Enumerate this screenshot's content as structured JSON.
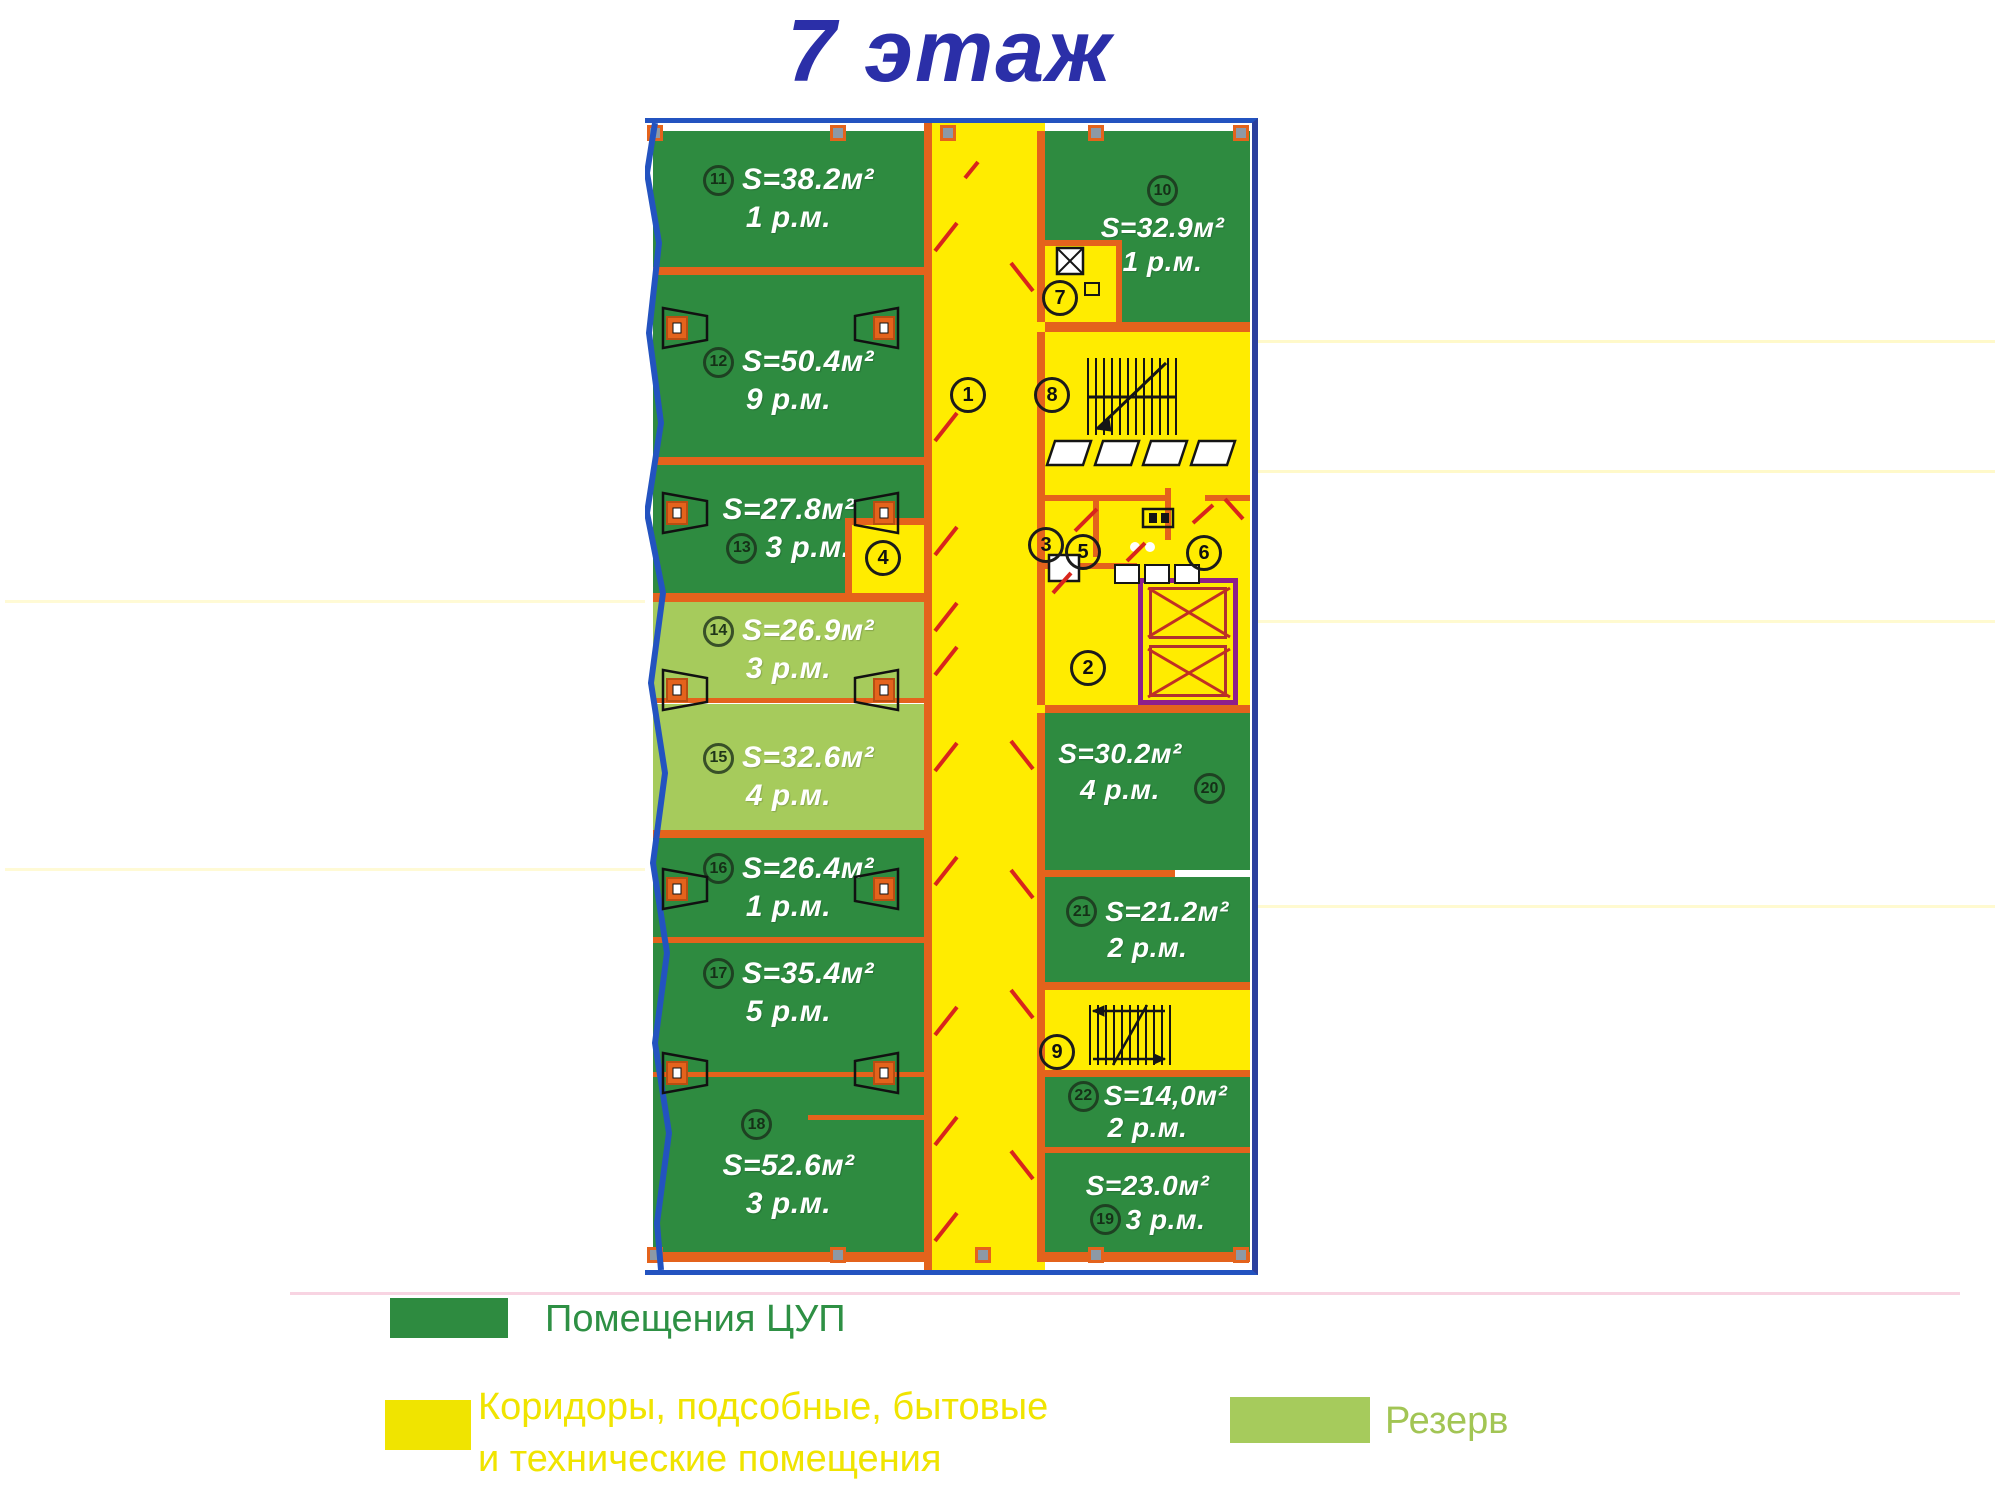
{
  "title": "7 этаж",
  "rooms": [
    {
      "num": "11",
      "area": "S=38.2м²",
      "places": "1 р.м.",
      "type": "cup"
    },
    {
      "num": "12",
      "area": "S=50.4м²",
      "places": "9 р.м.",
      "type": "cup"
    },
    {
      "num": "13",
      "area": "S=27.8м²",
      "places": "3 р.м.",
      "type": "cup"
    },
    {
      "num": "14",
      "area": "S=26.9м²",
      "places": "3 р.м.",
      "type": "reserve"
    },
    {
      "num": "15",
      "area": "S=32.6м²",
      "places": "4 р.м.",
      "type": "reserve"
    },
    {
      "num": "16",
      "area": "S=26.4м²",
      "places": "1 р.м.",
      "type": "cup"
    },
    {
      "num": "17",
      "area": "S=35.4м²",
      "places": "5 р.м.",
      "type": "cup"
    },
    {
      "num": "18",
      "area": "S=52.6м²",
      "places": "3 р.м.",
      "type": "cup"
    },
    {
      "num": "10",
      "area": "S=32.9м²",
      "places": "1 р.м.",
      "type": "cup"
    },
    {
      "num": "20",
      "area": "S=30.2м²",
      "places": "4 р.м.",
      "type": "cup"
    },
    {
      "num": "21",
      "area": "S=21.2м²",
      "places": "2 р.м.",
      "type": "cup"
    },
    {
      "num": "22",
      "area": "S=14,0м²",
      "places": "2 р.м.",
      "type": "cup"
    },
    {
      "num": "19",
      "area": "S=23.0м²",
      "places": "3 р.м.",
      "type": "cup"
    }
  ],
  "service": [
    "1",
    "2",
    "3",
    "4",
    "5",
    "6",
    "7",
    "8",
    "9"
  ],
  "legend": {
    "cup": {
      "label": "Помещения ЦУП"
    },
    "corridor": {
      "line1": "Коридоры, подсобные, бытовые",
      "line2": "и технические помещения"
    },
    "reserve": {
      "label": "Резерв"
    }
  },
  "colors": {
    "cup": "#2e8b40",
    "reserve": "#a6cb5c",
    "corridor": "#ffec00",
    "wall": "#e4631c",
    "facade": "#2353c0",
    "border_right": "#2b3f9e",
    "title": "#2b2fa8",
    "elevator": "#8e1f8b",
    "door": "#d8251c",
    "legend_cup_text": "#2e9044",
    "legend_corridor_text": "#f0e400",
    "legend_reserve_text": "#a2c554"
  }
}
